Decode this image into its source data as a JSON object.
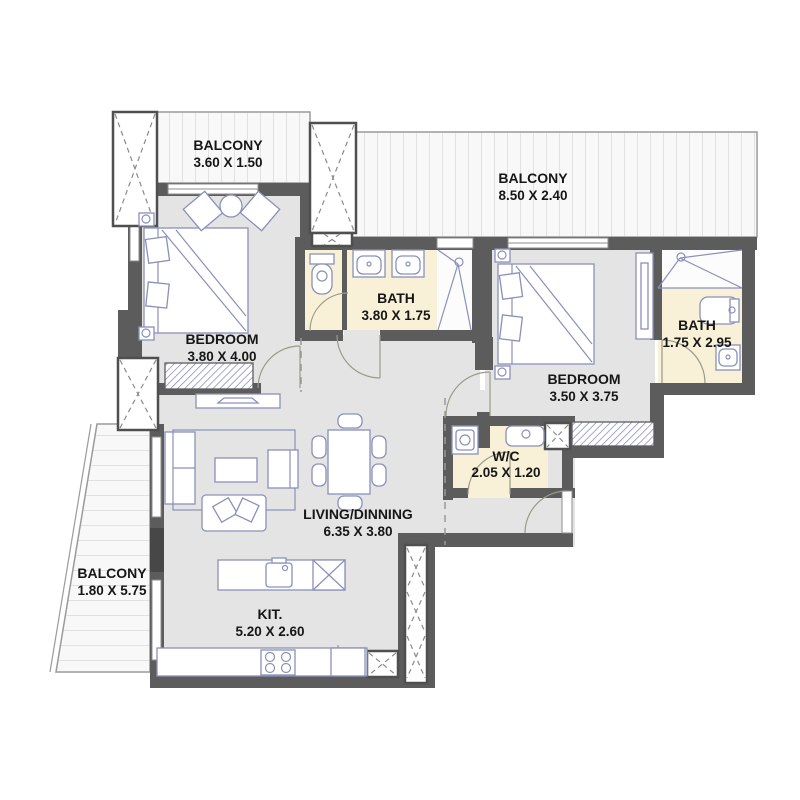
{
  "plan_type": "apartment-floor-plan",
  "colors": {
    "wall": "#5c5c5c",
    "floor": "#e4e4e4",
    "bath_floor": "#f8f1d8",
    "balcony_floor": "#f8f8f8",
    "furniture_stroke": "#8a90b8",
    "label_text": "#161616"
  },
  "rooms": {
    "balcony1": {
      "name": "BALCONY",
      "dims": "3.60 X 1.50"
    },
    "balcony2": {
      "name": "BALCONY",
      "dims": "8.50 X 2.40"
    },
    "bedroom1": {
      "name": "BEDROOM",
      "dims": "3.80 X 4.00"
    },
    "bath1": {
      "name": "BATH",
      "dims": "3.80 X 1.75"
    },
    "bedroom2": {
      "name": "BEDROOM",
      "dims": "3.50 X 3.75"
    },
    "bath2": {
      "name": "BATH",
      "dims": "1.75 X 2.95"
    },
    "wc": {
      "name": "W/C",
      "dims": "2.05 X 1.20"
    },
    "living": {
      "name": "LIVING/DINNING",
      "dims": "6.35 X 3.80"
    },
    "balcony3": {
      "name": "BALCONY",
      "dims": "1.80 X 5.75"
    },
    "kitchen": {
      "name": "KIT.",
      "dims": "5.20 X 2.60"
    }
  }
}
